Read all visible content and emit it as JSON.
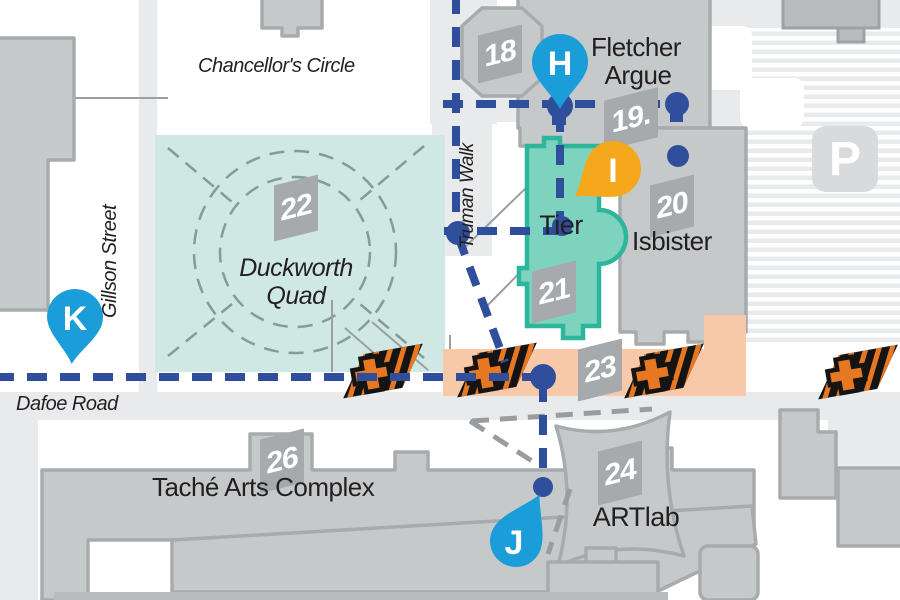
{
  "streets": {
    "chancellors_circle": "Chancellor's Circle",
    "gillson": "Gillson Street",
    "truman": "Truman Walk",
    "dafoe": "Dafoe Road"
  },
  "places": {
    "fletcher_line1": "Fletcher",
    "fletcher_line2": "Argue",
    "tier": "Tier",
    "isbister": "Isbister",
    "duckworth_line1": "Duckworth",
    "duckworth_line2": "Quad",
    "tache": "Taché Arts Complex",
    "artlab": "ARTlab"
  },
  "building_numbers": {
    "b18": "18",
    "b19": "19.",
    "b20": "20",
    "b21": "21",
    "b22": "22",
    "b23": "23",
    "b24": "24",
    "b26": "26"
  },
  "pins": {
    "h": "H",
    "i": "I",
    "j": "J",
    "k": "K"
  },
  "parking": {
    "label": "P"
  },
  "colors": {
    "pin_blue": "#1b9dd9",
    "pin_yellow": "#f5a81c",
    "path_blue": "#2f4f9c",
    "tier_fill": "#7ed3bf",
    "tier_border": "#2db69b",
    "quad_fill": "#cfe8e4",
    "zone_peach": "#f8c9a9",
    "construction_orange": "#e87722",
    "building_fill": "#c6c9ca",
    "road_gray": "#e9eaeb"
  }
}
